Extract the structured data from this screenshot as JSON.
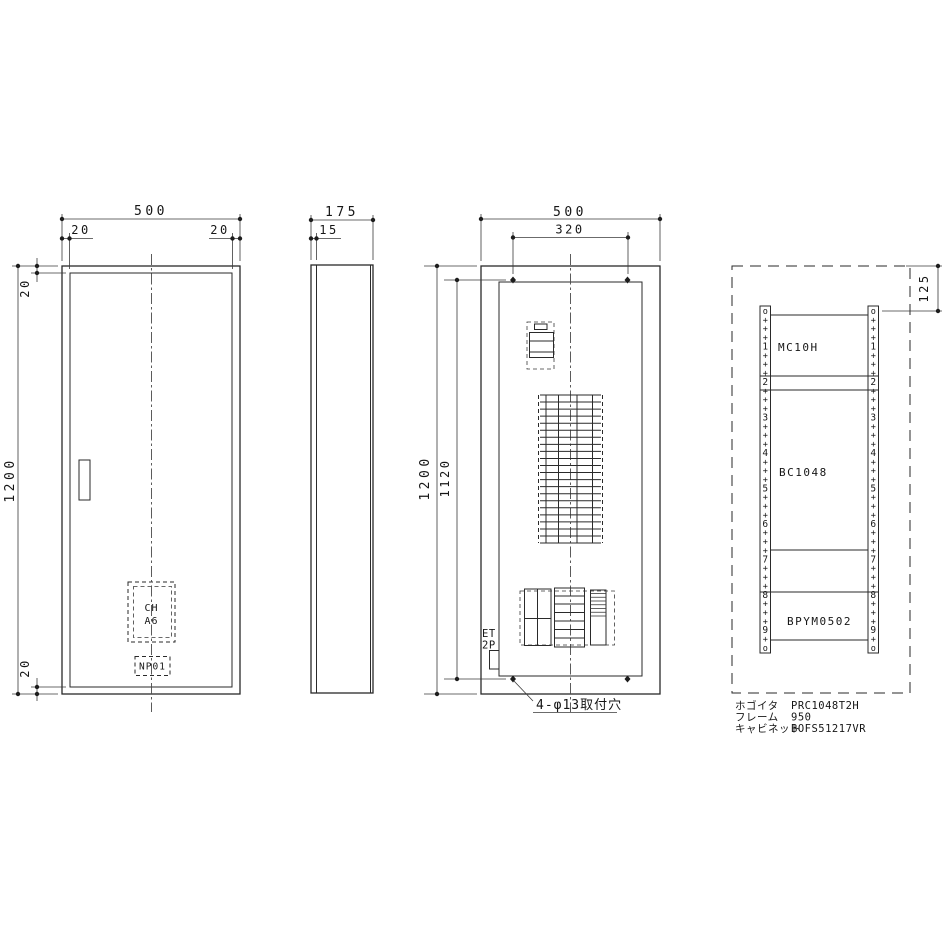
{
  "front": {
    "dim_width": "500",
    "dim_margin_left": "20",
    "dim_margin_right": "20",
    "dim_height": "1200",
    "dim_top": "20",
    "dim_bottom": "20",
    "nameplate": [
      "CH",
      "A6"
    ],
    "tag": "NP01"
  },
  "side": {
    "dim_depth": "175",
    "dim_door": "15"
  },
  "internal": {
    "dim_width": "500",
    "dim_hole_span": "320",
    "dim_height": "1200",
    "dim_hole_height": "1120",
    "breaker_label_line1": "ET",
    "breaker_label_line2": "2P",
    "note": "4-φ13取付穴"
  },
  "layout": {
    "dim_top_offset": "125",
    "sections": [
      "MC10H",
      "BC1048",
      "BPYM0502"
    ],
    "rail_marks": [
      "o",
      "+",
      "+",
      "+",
      "1",
      "+",
      "+",
      "+",
      "2",
      "+",
      "+",
      "+",
      "3",
      "+",
      "+",
      "+",
      "4",
      "+",
      "+",
      "+",
      "5",
      "+",
      "+",
      "+",
      "6",
      "+",
      "+",
      "+",
      "7",
      "+",
      "+",
      "+",
      "8",
      "+",
      "+",
      "+",
      "9",
      "+",
      "o"
    ],
    "specs": [
      {
        "label": "ホゴイタ",
        "value": "PRC1048T2H"
      },
      {
        "label": "フレーム",
        "value": "950"
      },
      {
        "label": "キャビネット",
        "value": "BOFS51217VR"
      }
    ]
  }
}
